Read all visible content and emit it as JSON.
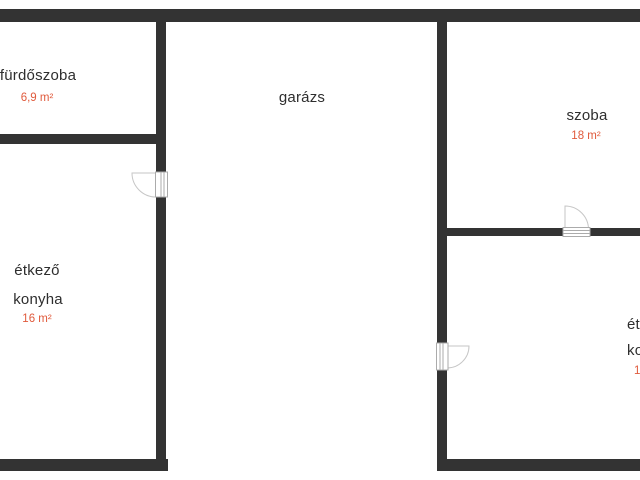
{
  "colors": {
    "page_bg": "#ffffff",
    "wall": "#333333",
    "room_label": "#2e2e2e",
    "area_label": "#e05a3c",
    "door_outline": "#c6c6c6",
    "door_frame_outline": "#ababab"
  },
  "rooms": [
    {
      "id": "bathroom",
      "name": "fürdőszoba",
      "area": "6,9 m²"
    },
    {
      "id": "garage",
      "name": "garázs"
    },
    {
      "id": "bedroom",
      "name": "szoba",
      "area": "18 m²"
    },
    {
      "id": "dining-kitchen",
      "name_line1": "étkező",
      "name_line2": "konyha",
      "area": "16 m²"
    },
    {
      "id": "dining-kitchen-right-partial",
      "name_line1": "ét",
      "name_line2": "ko",
      "area": "1"
    }
  ]
}
